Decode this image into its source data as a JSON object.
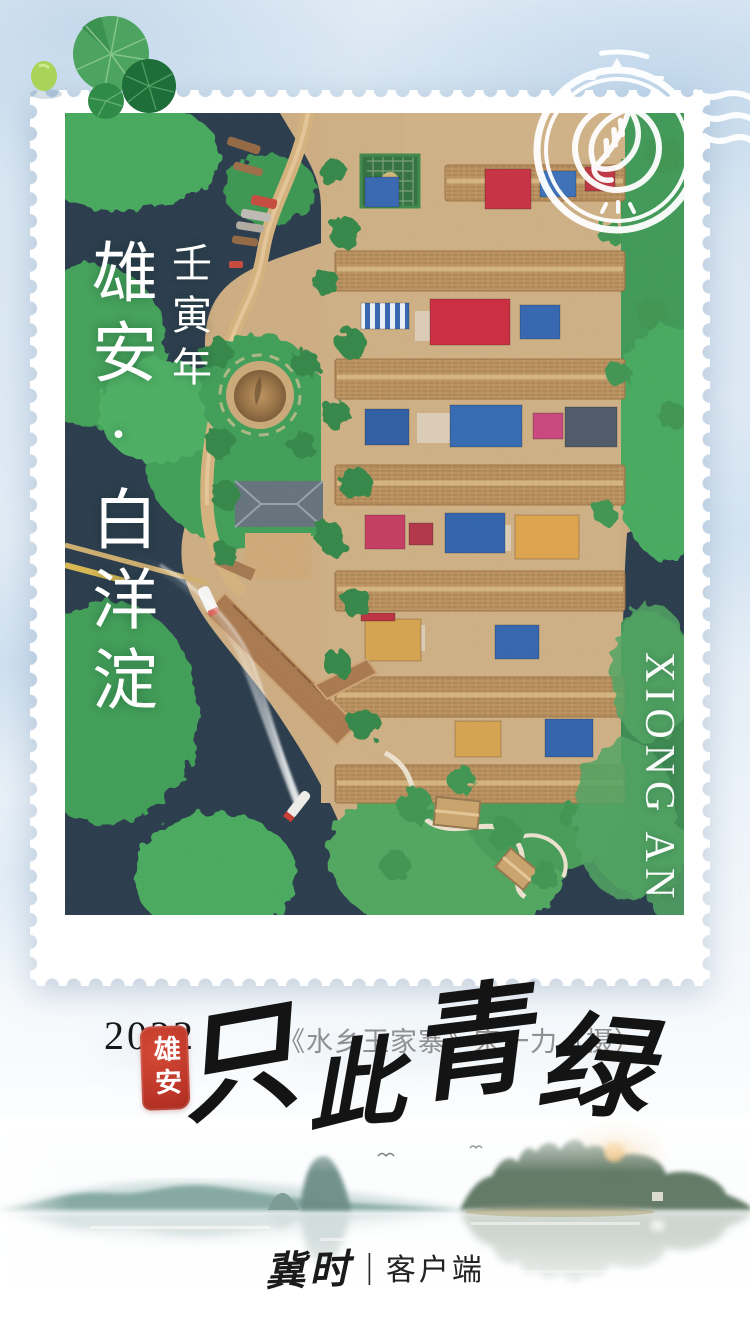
{
  "stamp": {
    "title": "雄安·白洋淀",
    "era": "壬寅年",
    "side_label": "XIONG AN",
    "year": "2022",
    "credit": "《水乡王家寨》宋一力（摄）"
  },
  "postmark": {
    "icon": "leaf-icon"
  },
  "decorations": {
    "top_left": "lily-pad-icon"
  },
  "seal": {
    "text": "雄安",
    "chars": [
      "雄",
      "安"
    ]
  },
  "slogan": {
    "text": "只此青绿",
    "chars": [
      "只",
      "此",
      "青",
      "绿"
    ]
  },
  "footer": {
    "brand": "冀时",
    "divider": "|",
    "label": "客户端"
  },
  "colors": {
    "background_blue": "#dce8f4",
    "stamp_white": "#ffffff",
    "water_dark": "#16293b",
    "vegetation_green": "#2f9447",
    "seal_red": "#bb3427",
    "calligraphy_black": "#141414",
    "credit_gray": "#8f8f8f"
  }
}
